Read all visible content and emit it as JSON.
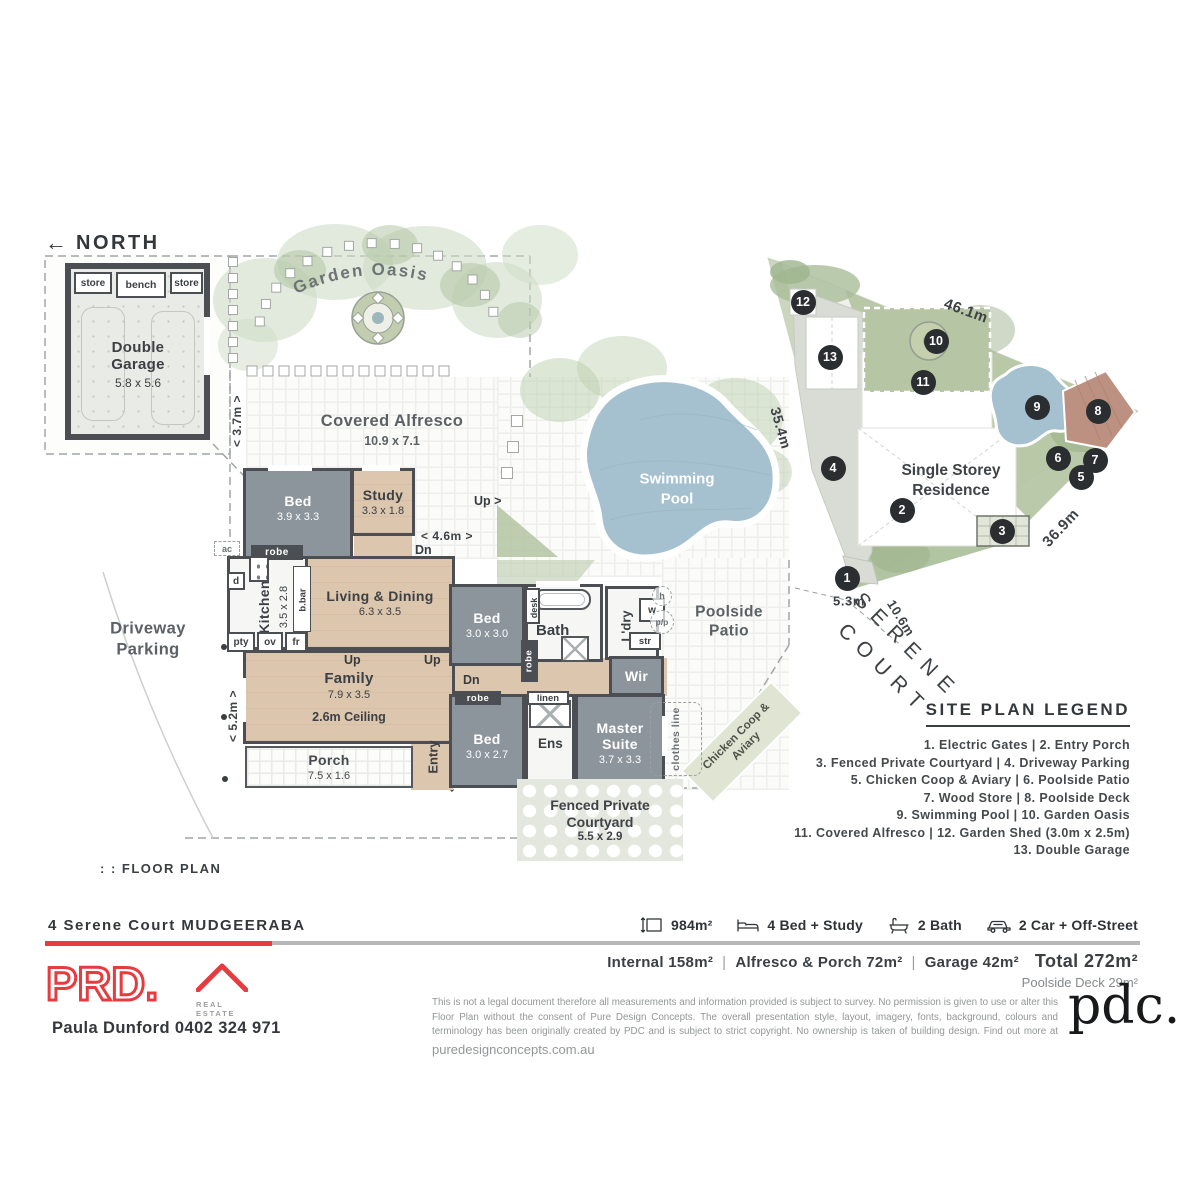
{
  "floor_plan": {
    "north": "NORTH",
    "plan_label": ": : FLOOR PLAN",
    "garage": {
      "title": "Double Garage",
      "dim": "5.8 x 5.6",
      "store_left": "store",
      "bench": "bench",
      "store_right": "store"
    },
    "garden_oasis": "Garden Oasis",
    "alfresco": {
      "title": "Covered Alfresco",
      "dim": "10.9 x 7.1"
    },
    "pool": "Swimming Pool",
    "poolside_patio": "Poolside Patio",
    "driveway": "Driveway Parking",
    "chicken_coop": "Chicken Coop & Aviary",
    "clothes_line": "clothes line",
    "courtyard": {
      "title": "Fenced Private Courtyard",
      "dim": "5.5 x 2.9"
    },
    "rooms": {
      "bed1": {
        "name": "Bed",
        "dim": "3.9 x 3.3"
      },
      "study": {
        "name": "Study",
        "dim": "3.3 x 1.8"
      },
      "kitchen": {
        "name": "Kitchen",
        "dim": "3.5 x 2.8"
      },
      "living": {
        "name": "Living & Dining",
        "dim": "6.3 x 3.5"
      },
      "family": {
        "name": "Family",
        "dim": "7.9 x 3.5",
        "ceiling": "2.6m Ceiling"
      },
      "porch": {
        "name": "Porch",
        "dim": "7.5 x 1.6"
      },
      "entry": "Entry",
      "bed2": {
        "name": "Bed",
        "dim": "3.0 x 3.0"
      },
      "bath": "Bath",
      "laundry": "L'dry",
      "wir": "Wir",
      "bed3": {
        "name": "Bed",
        "dim": "3.0 x 2.7"
      },
      "ens": "Ens",
      "master": {
        "name": "Master Suite",
        "dim": "3.7 x 3.3"
      }
    },
    "tags": {
      "robe": "robe",
      "linen": "linen",
      "desk": "desk",
      "bbar": "b.bar",
      "pty": "pty",
      "ov": "ov",
      "fr": "fr",
      "d": "d",
      "w": "w",
      "str": "str",
      "h": "h",
      "pp": "p/p",
      "ac": "ac",
      "up": "Up",
      "up_arrow": "Up >",
      "dn": "Dn"
    },
    "dims": {
      "d37": "< 3.7m >",
      "d46": "< 4.6m >",
      "d52": "< 5.2m >"
    }
  },
  "site_plan": {
    "residence": "Single Storey Residence",
    "street": "SERENE COURT",
    "dims": {
      "top": "46.1m",
      "left": "35.4m",
      "right": "36.9m",
      "frontage": "5.3m",
      "frontage2": "10.6m"
    },
    "markers": [
      {
        "n": "1",
        "x": 847,
        "y": 578
      },
      {
        "n": "2",
        "x": 902,
        "y": 510
      },
      {
        "n": "3",
        "x": 1002,
        "y": 531
      },
      {
        "n": "4",
        "x": 833,
        "y": 468
      },
      {
        "n": "5",
        "x": 1081,
        "y": 477
      },
      {
        "n": "6",
        "x": 1058,
        "y": 458
      },
      {
        "n": "7",
        "x": 1095,
        "y": 460
      },
      {
        "n": "8",
        "x": 1098,
        "y": 411
      },
      {
        "n": "9",
        "x": 1037,
        "y": 407
      },
      {
        "n": "10",
        "x": 936,
        "y": 341
      },
      {
        "n": "11",
        "x": 923,
        "y": 382
      },
      {
        "n": "12",
        "x": 803,
        "y": 302
      },
      {
        "n": "13",
        "x": 830,
        "y": 357
      }
    ]
  },
  "legend": {
    "title": "SITE PLAN LEGEND",
    "rows": [
      "1. Electric Gates  |  2. Entry Porch",
      "3. Fenced Private Courtyard |  4. Driveway Parking",
      "5. Chicken Coop & Aviary  |  6. Poolside Patio",
      "7. Wood Store  |  8. Poolside Deck",
      "9. Swimming Pool  |  10. Garden Oasis",
      "11. Covered Alfresco  |  12. Garden Shed (3.0m x 2.5m)",
      "13. Double Garage"
    ]
  },
  "footer": {
    "address": "4 Serene Court MUDGEERABA",
    "stats": [
      {
        "icon": "land-size-icon",
        "label": "984m²"
      },
      {
        "icon": "bed-icon",
        "label": "4 Bed + Study"
      },
      {
        "icon": "bath-icon",
        "label": "2 Bath"
      },
      {
        "icon": "car-icon",
        "label": "2 Car + Off-Street"
      }
    ],
    "areas": {
      "internal": "Internal 158m²",
      "divider": "|",
      "alfresco": "Alfresco & Porch 72m²",
      "garage": "Garage 42m²",
      "total": "Total 272m²",
      "poolside": "Poolside Deck 29m²"
    },
    "brand": {
      "name": "PRD.",
      "sub": "REAL ESTATE"
    },
    "agent": "Paula Dunford  0402 324 971",
    "disclaimer": "This is not a legal document therefore all measurements and information provided is subject to survey. No permission is given to use or alter this Floor Plan without the consent of Pure Design Concepts. The overall presentation style, layout, imagery, fonts, background, colours and terminology has been originally created by PDC and is subject to strict copyright. No ownership is taken of building design. Find out more at ",
    "disclaimer_link": "puredesignconcepts.com.au",
    "pdc_logo": "pdc."
  }
}
